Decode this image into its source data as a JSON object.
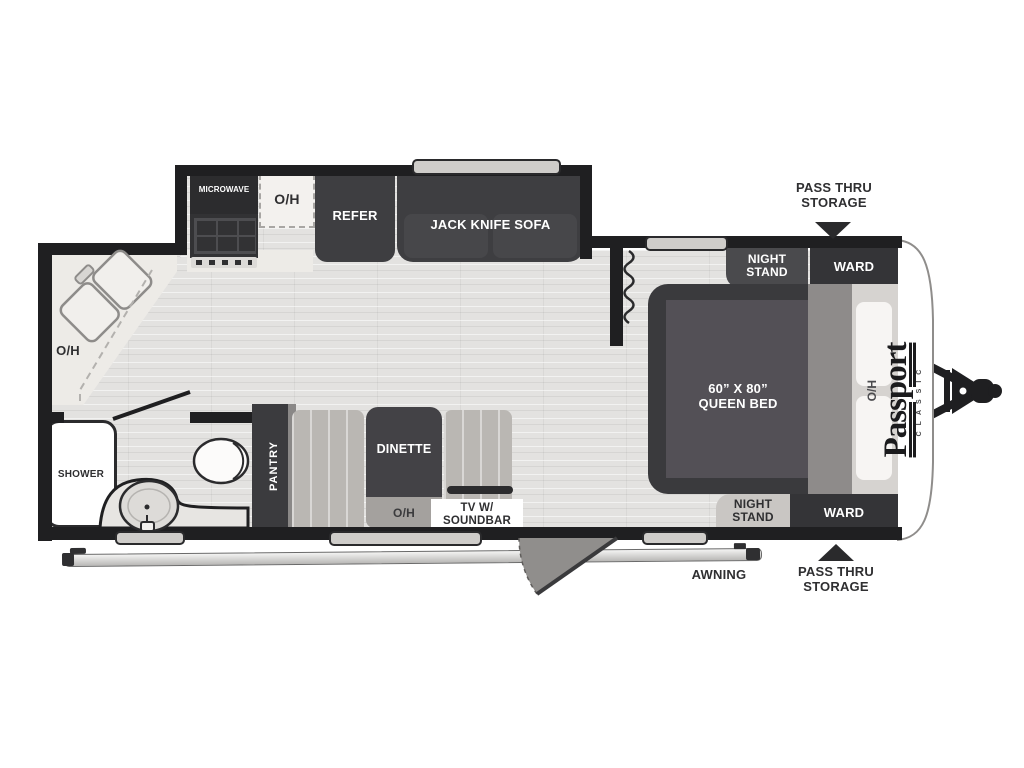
{
  "colors": {
    "wall": "#1f1f21",
    "furniture_dark": "#3e3e41",
    "floor": "#e3e2e0",
    "counter_light": "#edebe7",
    "bench_gray": "#bab7b3",
    "panel_gray": "#8e8b8a"
  },
  "logo": {
    "name": "Passport",
    "series": "CLASSIC"
  },
  "kitchen": {
    "microwave": "MICROWAVE",
    "overhead": "O/H",
    "refrigerator": "REFER",
    "sofa": "JACK KNIFE SOFA"
  },
  "bath": {
    "overhead": "O/H",
    "shower": "SHOWER"
  },
  "living": {
    "pantry": "PANTRY",
    "dinette": "DINETTE",
    "overhead": "O/H",
    "tv": "TV W/ SOUNDBAR"
  },
  "bedroom": {
    "bed_size": "60” X 80”",
    "bed_type": "QUEEN BED",
    "overhead": "O/H",
    "night_stand_top": "NIGHT STAND",
    "ward_top": "WARD",
    "night_stand_bottom": "NIGHT STAND",
    "ward_bottom": "WARD"
  },
  "exterior": {
    "pass_thru_top": "PASS THRU STORAGE",
    "pass_thru_bottom": "PASS THRU STORAGE",
    "awning": "AWNING"
  }
}
